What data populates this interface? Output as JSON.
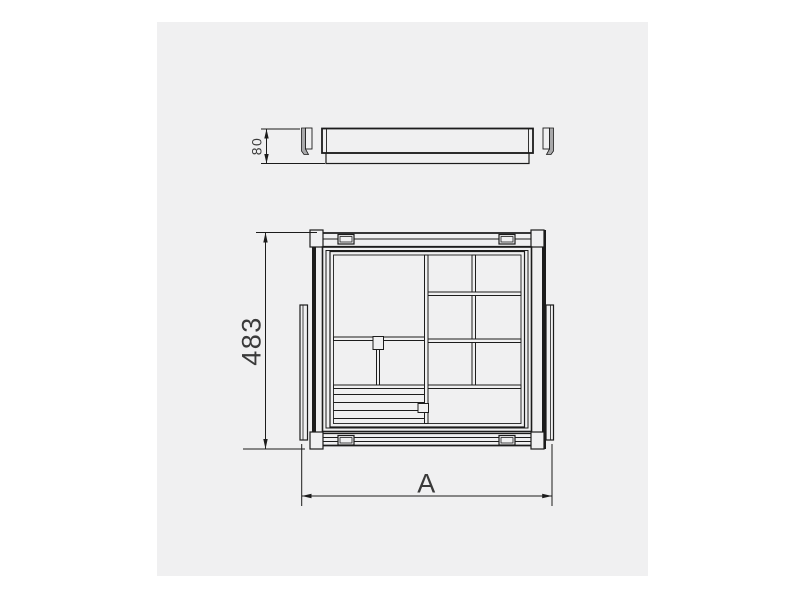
{
  "theme": {
    "page-bg": "#ffffff",
    "panel-bg": "#f0f0f1",
    "line": "#1c1c1c",
    "shade": "#a8a8aa",
    "dim-text": "#3a3a3a"
  },
  "drawing": {
    "dimensions": {
      "height": "80",
      "depth": "483",
      "width": "A"
    }
  }
}
